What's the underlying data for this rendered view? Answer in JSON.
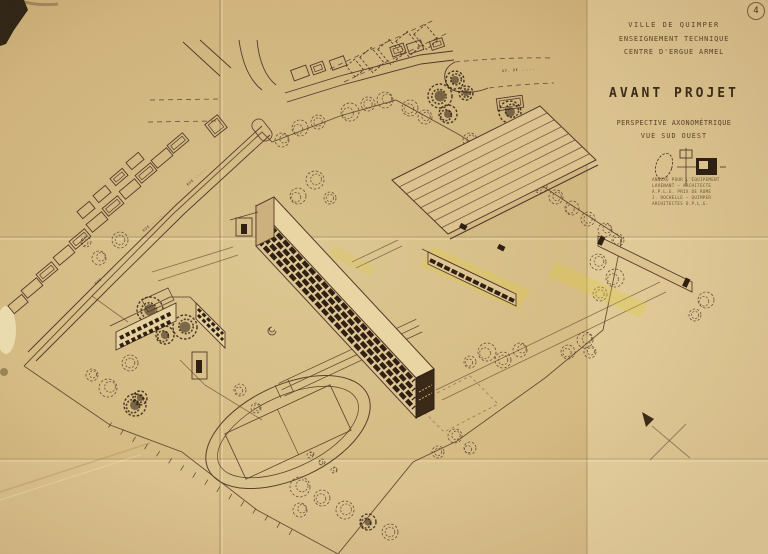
{
  "page": {
    "number": "4"
  },
  "title_block": {
    "municipality": "VILLE DE QUIMPER",
    "program": "ENSEIGNEMENT TECHNIQUE",
    "center": "CENTRE D'ERGUE ARMEL",
    "title": "AVANT PROJET",
    "subtitle_line1": "PERSPECTIVE AXONOMÉTRIQUE",
    "subtitle_line2": "VUE SUD OUEST",
    "credits": [
      "ANNEXE POUR L'ÉQUIPEMENT",
      "LAVENANT — ARCHITECTE",
      "A.P.L.G. PRIX DE ROME",
      "J. ROCHELLE — QUIMPER",
      "ARCHITECTES D.P.L.G."
    ]
  },
  "street_labels": {
    "rue1": "RUE .....",
    "rue2": "RUE .....",
    "rue3": "RUE .....",
    "avenue": "AV. DE ....."
  },
  "colors": {
    "ink": "#53392a",
    "ink_dark": "#2e1f12",
    "paper": "#d7bd87",
    "highlight": "#e0cc38"
  },
  "plan": {
    "roads_solid": [
      "M262,126 L176,205 L98,282 L28,352",
      "M270,135 L184,214 L106,291 L36,361",
      "M285,93 L340,76 L420,55 L453,51",
      "M287,102 L342,85 L421,64 L454,60",
      "M239,40 Q244,76 262,90",
      "M257,40 Q260,72 276,85",
      "M183,42 L220,76",
      "M200,40 L231,68",
      "M455,62 Q443,68 445,79 Q447,92 463,92 Q477,93 488,88"
    ],
    "roads_dashed": [
      "M150,100 L220,99",
      "M148,122 L216,121",
      "M455,62 Q505,57 553,58",
      "M489,88 Q522,84 554,83",
      "M344,82 L450,32",
      "M330,69 L434,20"
    ],
    "boundary": "24,366 96,292 173,214 262,132 272,142 340,116 396,100 458,134 530,178 622,238 603,330 545,378 503,408 457,441 413,462 338,554 257,510 182,452 110,425 24,366",
    "fence": {
      "x1": 110,
      "y1": 425,
      "x2": 300,
      "y2": 538,
      "step": 14
    },
    "houses": [
      [
        178,
        143,
        20,
        10,
        -40,
        1
      ],
      [
        162,
        158,
        20,
        10,
        -40,
        0
      ],
      [
        146,
        173,
        20,
        10,
        -40,
        1
      ],
      [
        130,
        189,
        20,
        10,
        -40,
        0
      ],
      [
        113,
        206,
        20,
        10,
        -40,
        1
      ],
      [
        97,
        222,
        20,
        10,
        -40,
        0
      ],
      [
        80,
        239,
        20,
        10,
        -40,
        1
      ],
      [
        64,
        255,
        20,
        10,
        -40,
        0
      ],
      [
        47,
        272,
        20,
        10,
        -40,
        1
      ],
      [
        32,
        288,
        20,
        10,
        -40,
        0
      ],
      [
        18,
        304,
        18,
        10,
        -40,
        0
      ],
      [
        135,
        161,
        16,
        9,
        -40,
        0
      ],
      [
        119,
        177,
        16,
        9,
        -40,
        1
      ],
      [
        102,
        194,
        16,
        9,
        -40,
        0
      ],
      [
        86,
        210,
        16,
        9,
        -40,
        0
      ],
      [
        216,
        126,
        16,
        16,
        -38,
        1
      ],
      [
        300,
        73,
        16,
        11,
        -20,
        0
      ],
      [
        318,
        68,
        13,
        10,
        -20,
        1
      ],
      [
        338,
        63,
        15,
        10,
        -20,
        0
      ],
      [
        398,
        50,
        14,
        10,
        -18,
        1
      ],
      [
        415,
        47,
        15,
        10,
        -18,
        0
      ],
      [
        437,
        44,
        13,
        9,
        -18,
        1
      ],
      [
        510,
        103,
        26,
        12,
        -8,
        1
      ],
      [
        372,
        60,
        15,
        20,
        -40,
        2
      ],
      [
        390,
        52,
        15,
        20,
        -40,
        2
      ],
      [
        408,
        44,
        15,
        20,
        -40,
        2
      ],
      [
        426,
        37,
        15,
        20,
        -40,
        2
      ],
      [
        355,
        68,
        11,
        14,
        -40,
        2
      ],
      [
        262,
        130,
        13,
        24,
        -38,
        3
      ]
    ],
    "trees": [
      [
        350,
        112,
        9,
        0
      ],
      [
        368,
        104,
        7,
        0
      ],
      [
        385,
        100,
        8,
        0
      ],
      [
        410,
        108,
        8,
        0
      ],
      [
        425,
        117,
        7,
        0
      ],
      [
        300,
        128,
        8,
        0
      ],
      [
        318,
        122,
        7,
        0
      ],
      [
        282,
        140,
        7,
        0
      ],
      [
        440,
        96,
        12,
        1
      ],
      [
        455,
        80,
        9,
        1
      ],
      [
        448,
        114,
        9,
        1
      ],
      [
        466,
        93,
        7,
        1
      ],
      [
        510,
        112,
        11,
        1
      ],
      [
        523,
        128,
        9,
        1
      ],
      [
        470,
        140,
        7,
        0
      ],
      [
        488,
        152,
        7,
        0
      ],
      [
        505,
        163,
        7,
        0
      ],
      [
        522,
        174,
        7,
        0
      ],
      [
        540,
        186,
        7,
        0
      ],
      [
        556,
        197,
        7,
        0
      ],
      [
        572,
        208,
        7,
        0
      ],
      [
        588,
        219,
        7,
        0
      ],
      [
        605,
        230,
        7,
        0
      ],
      [
        618,
        240,
        6,
        0
      ],
      [
        598,
        262,
        8,
        0
      ],
      [
        615,
        278,
        9,
        0
      ],
      [
        600,
        294,
        7,
        0
      ],
      [
        585,
        340,
        8,
        0
      ],
      [
        568,
        352,
        7,
        0
      ],
      [
        590,
        352,
        6,
        0
      ],
      [
        487,
        352,
        9,
        0
      ],
      [
        503,
        360,
        8,
        0
      ],
      [
        520,
        350,
        7,
        0
      ],
      [
        470,
        362,
        6,
        0
      ],
      [
        455,
        436,
        7,
        0
      ],
      [
        470,
        448,
        6,
        0
      ],
      [
        438,
        452,
        6,
        0
      ],
      [
        300,
        487,
        10,
        0
      ],
      [
        322,
        498,
        8,
        0
      ],
      [
        345,
        510,
        9,
        0
      ],
      [
        368,
        522,
        8,
        1
      ],
      [
        390,
        532,
        8,
        0
      ],
      [
        300,
        510,
        7,
        0
      ],
      [
        150,
        310,
        13,
        1
      ],
      [
        185,
        327,
        12,
        1
      ],
      [
        165,
        335,
        9,
        1
      ],
      [
        130,
        363,
        8,
        0
      ],
      [
        108,
        388,
        9,
        0
      ],
      [
        140,
        398,
        7,
        1
      ],
      [
        92,
        375,
        6,
        0
      ],
      [
        135,
        405,
        11,
        1
      ],
      [
        120,
        240,
        8,
        0
      ],
      [
        99,
        258,
        7,
        0
      ],
      [
        86,
        242,
        5,
        0
      ],
      [
        315,
        180,
        9,
        0
      ],
      [
        298,
        196,
        8,
        0
      ],
      [
        330,
        198,
        6,
        0
      ],
      [
        282,
        214,
        6,
        0
      ],
      [
        240,
        390,
        6,
        0
      ],
      [
        256,
        408,
        5,
        0
      ],
      [
        706,
        300,
        8,
        0
      ],
      [
        695,
        315,
        6,
        0
      ],
      [
        310,
        455,
        3,
        0
      ],
      [
        322,
        462,
        3,
        0
      ],
      [
        334,
        470,
        3,
        0
      ]
    ]
  }
}
